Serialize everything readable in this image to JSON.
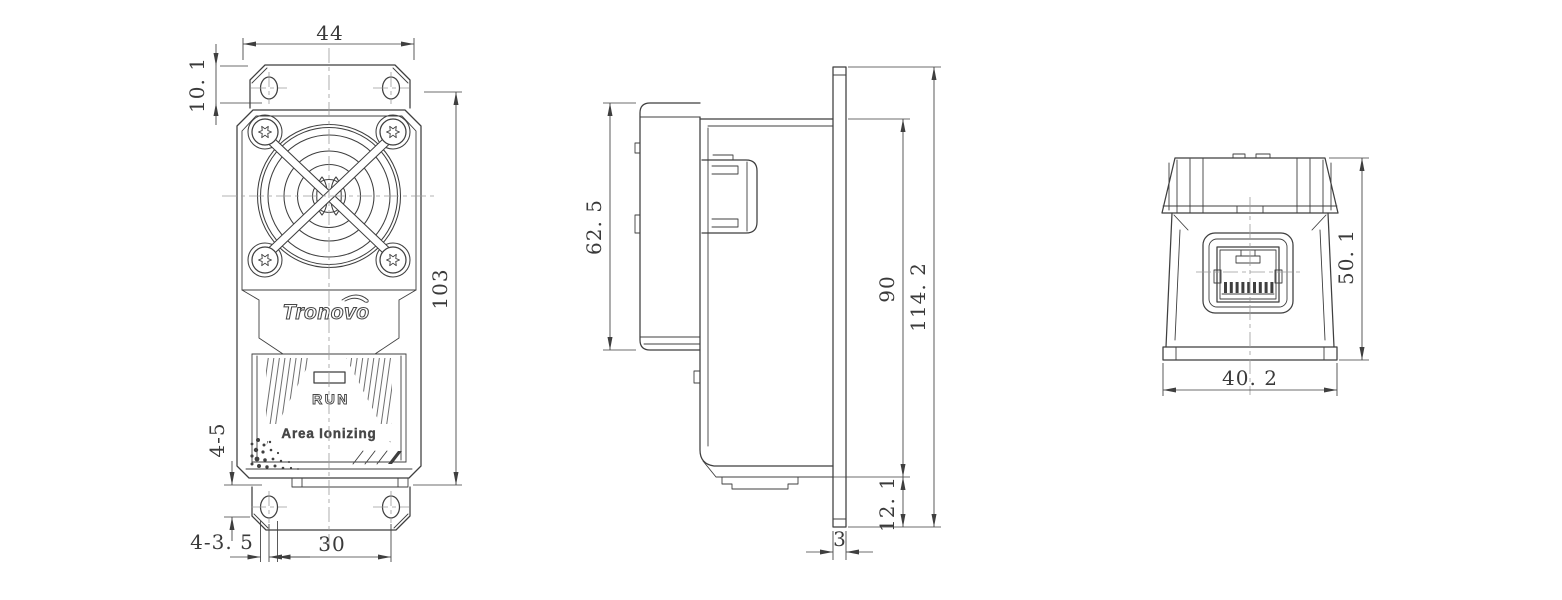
{
  "drawing": {
    "colors": {
      "line": "#3f3f3f",
      "dim": "#3a3a3a",
      "centerline": "#9b9b9b",
      "background": "#ffffff"
    },
    "front_view": {
      "logo": "Tronovo",
      "status_label": "RUN",
      "product_label": "Area Ionizing",
      "dims": {
        "flange_width": "44",
        "flange_offset": "10. 1",
        "body_height": "103",
        "slot_length": "4-5",
        "slot_width": "4-3. 5",
        "slot_spacing": "30"
      }
    },
    "side_view": {
      "dims": {
        "rear_depth": "62. 5",
        "panel_height": "90",
        "overall_height": "114. 2",
        "bottom_offset": "12. 1",
        "plate_thickness": "3"
      }
    },
    "rear_view": {
      "dims": {
        "connector_height": "50. 1",
        "connector_width": "40. 2"
      }
    }
  }
}
